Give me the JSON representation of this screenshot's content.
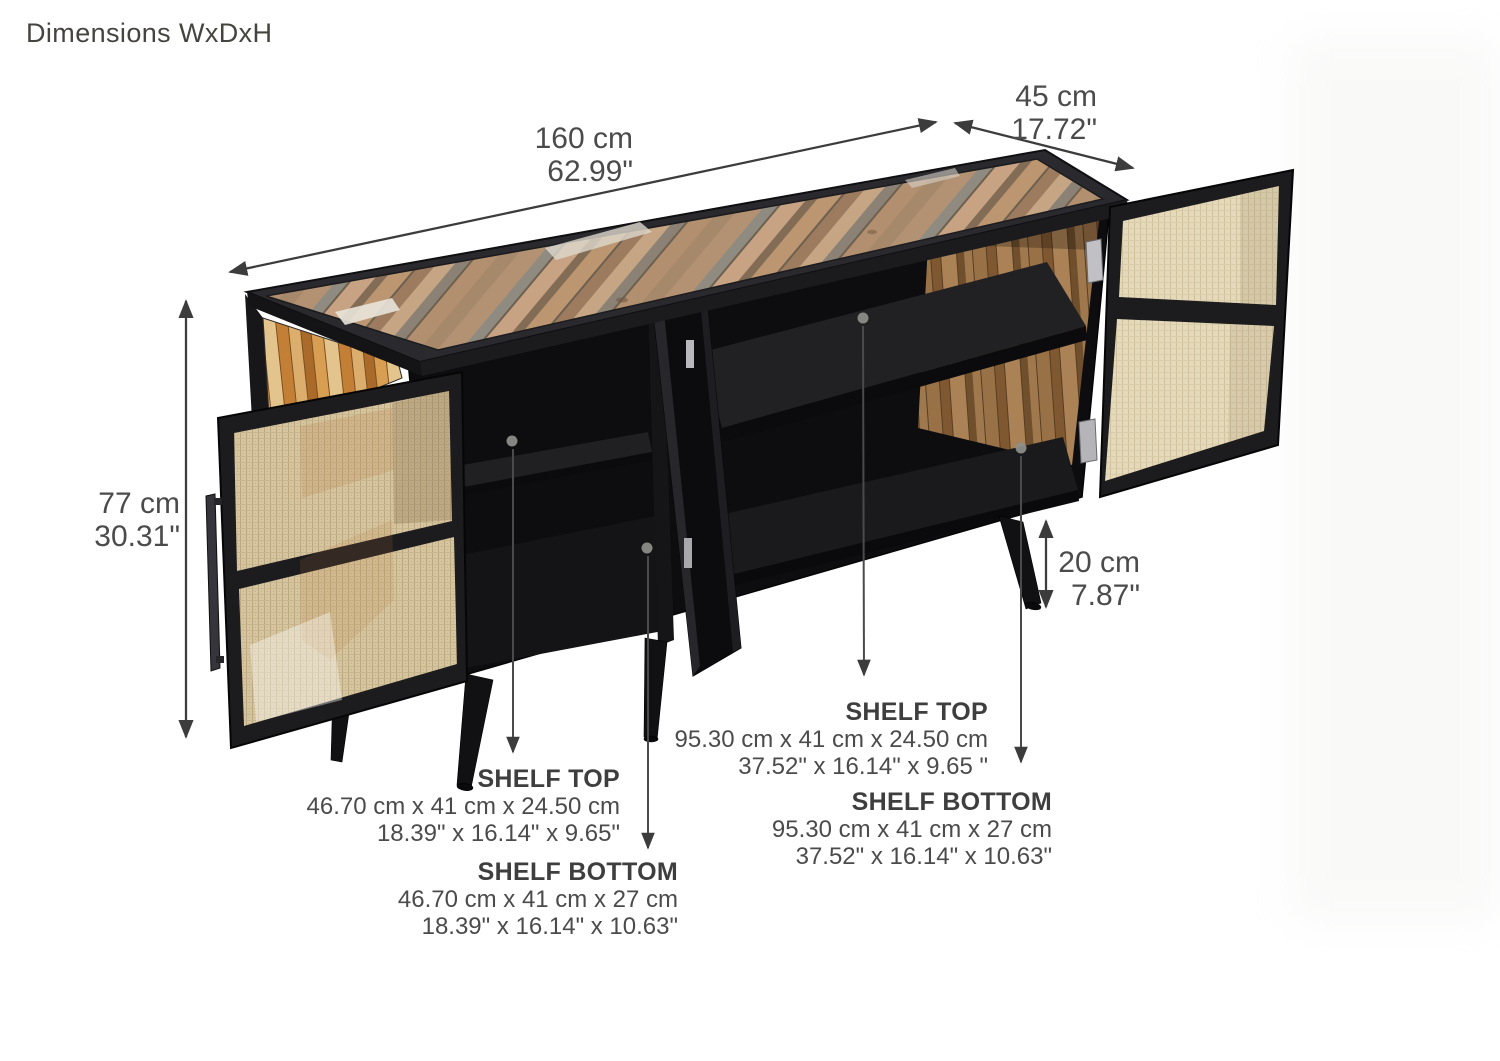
{
  "title": "Dimensions WxDxH",
  "dims": {
    "width": {
      "cm": "160 cm",
      "in": "62.99\""
    },
    "depth": {
      "cm": "45 cm",
      "in": "17.72\""
    },
    "height": {
      "cm": "77 cm",
      "in": "30.31\""
    },
    "leg": {
      "cm": "20 cm",
      "in": "7.87\""
    }
  },
  "shelves": {
    "left_top": {
      "label": "SHELF TOP",
      "cm": "46.70 cm x 41 cm x 24.50 cm",
      "in": "18.39\" x 16.14\" x 9.65\""
    },
    "left_bottom": {
      "label": "SHELF BOTTOM",
      "cm": "46.70 cm x 41 cm x 27 cm",
      "in": "18.39\" x 16.14\" x 10.63\""
    },
    "right_top": {
      "label": "SHELF TOP",
      "cm": "95.30 cm x 41 cm x 24.50 cm",
      "in": "37.52\" x 16.14\" x 9.65 \""
    },
    "right_bottom": {
      "label": "SHELF BOTTOM",
      "cm": "95.30 cm x 41 cm x 27 cm",
      "in": "37.52\" x 16.14\" x 10.63\""
    }
  },
  "icons": {
    "dimension_arrow": "double-headed-arrow",
    "leader_arrow": "down-arrow",
    "leader_dot": "gray-dot"
  },
  "colors": {
    "text": "#4b4b4b",
    "label_bold": "#3e3e3e",
    "dimension_line": "#3c3c3c",
    "frame_black": "#1c1c1f",
    "cane": "#d7c5a0",
    "wood_top": "#b39274",
    "wood_side_orange": "#c37f35"
  }
}
